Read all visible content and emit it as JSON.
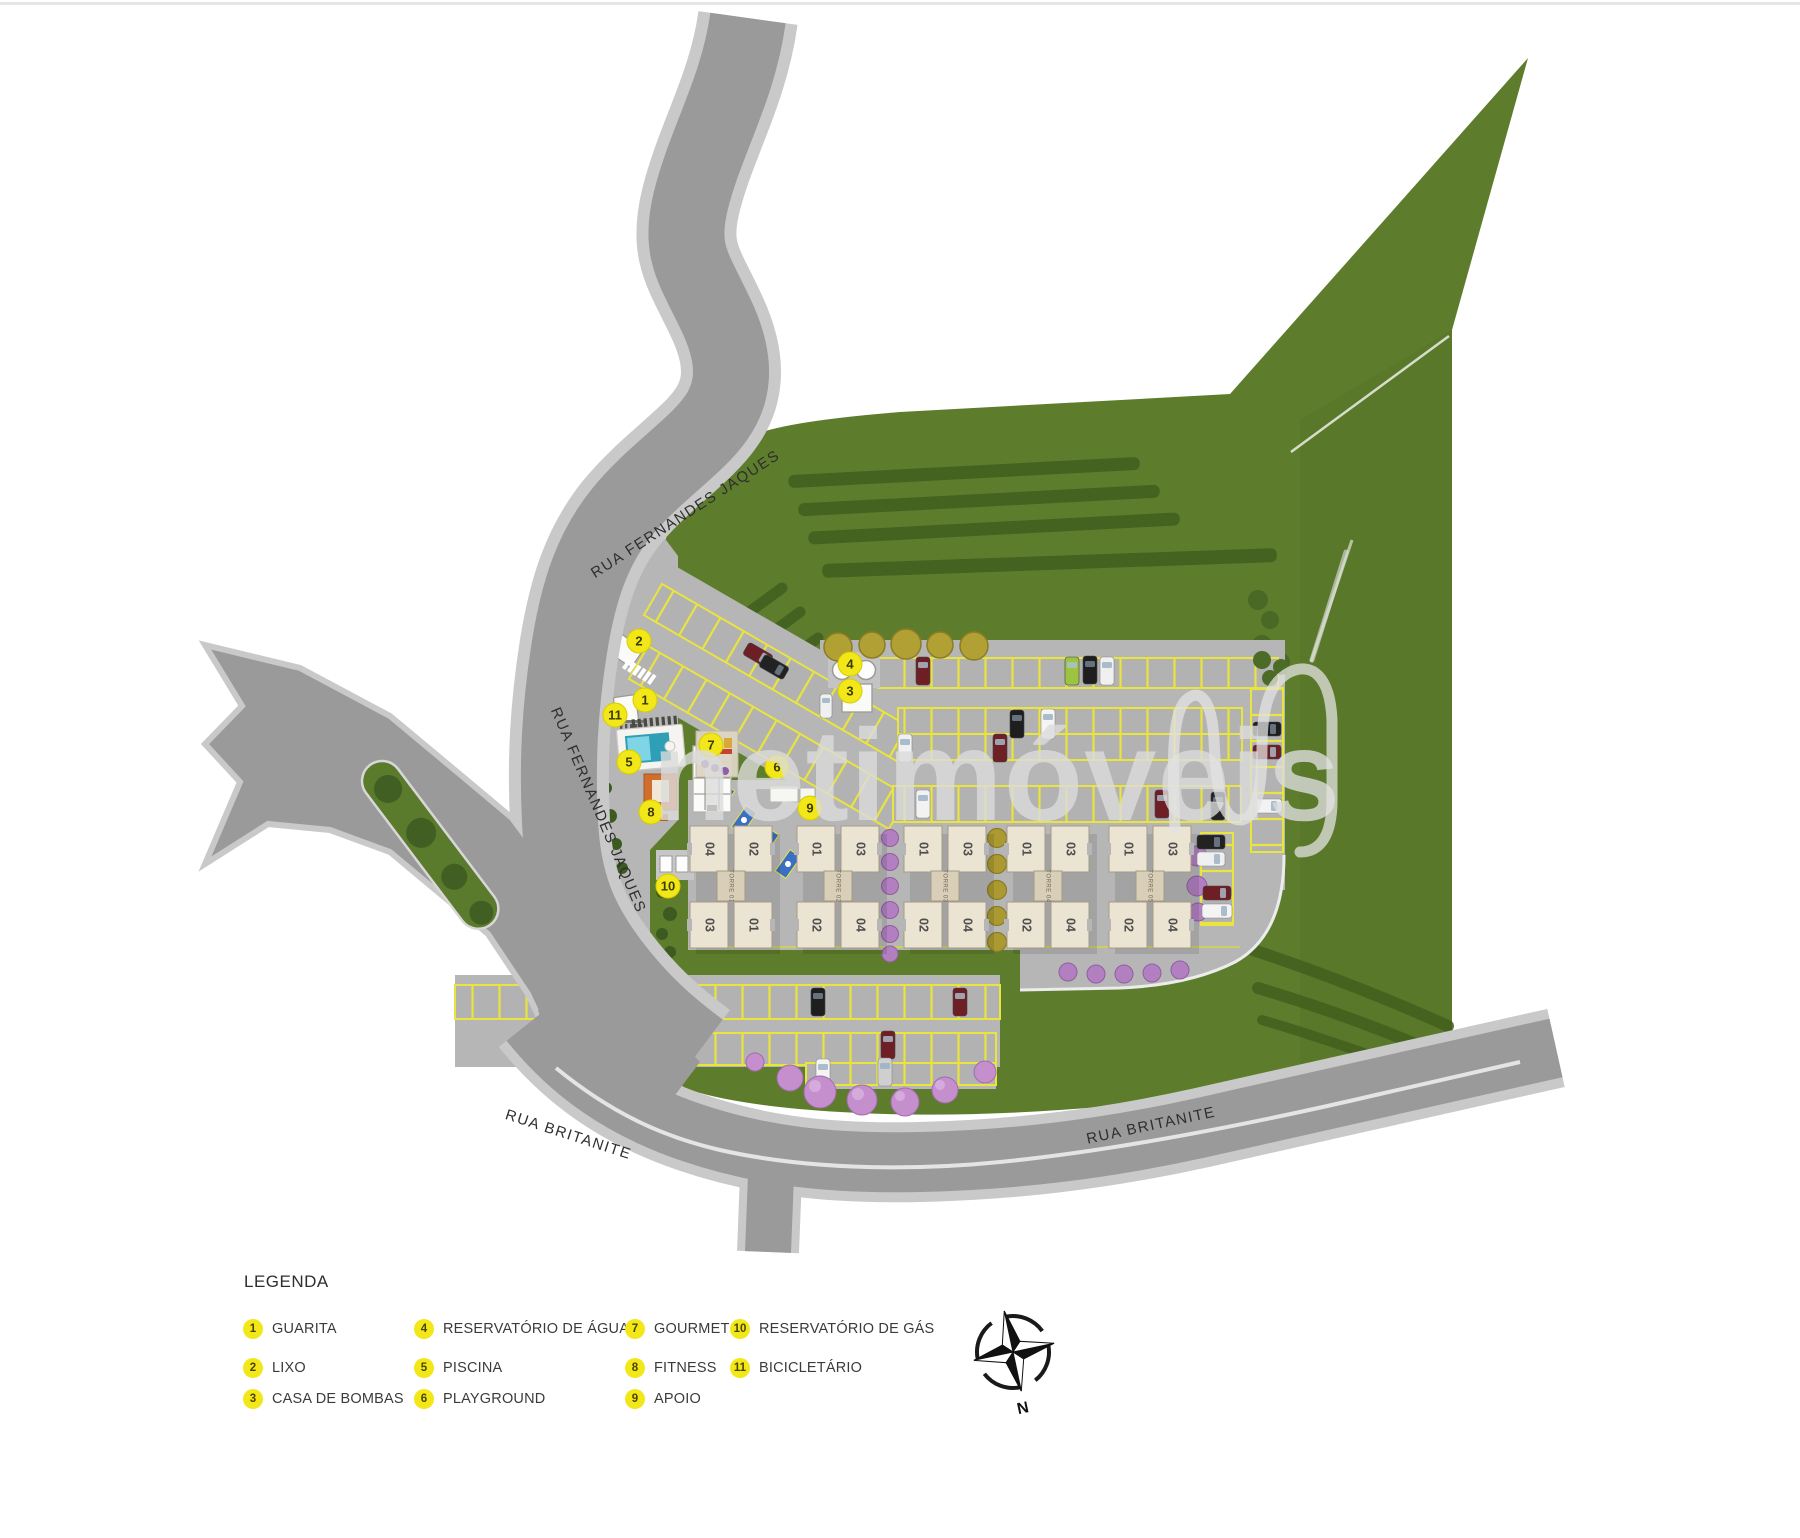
{
  "map": {
    "streets": {
      "fernandes_jaques": "RUA FERNANDES JAQUES",
      "britanite": "RUA BRITANITE"
    },
    "watermark_text": "netimóveis",
    "compass_north": "N",
    "towers": [
      {
        "name": "TORRE 01",
        "units": [
          "04",
          "02",
          "03",
          "01"
        ]
      },
      {
        "name": "TORRE 02",
        "units": [
          "01",
          "03",
          "02",
          "04"
        ]
      },
      {
        "name": "TORRE 03",
        "units": [
          "01",
          "03",
          "02",
          "04"
        ]
      },
      {
        "name": "TORRE 04",
        "units": [
          "01",
          "03",
          "02",
          "04"
        ]
      },
      {
        "name": "TORRE 05",
        "units": [
          "01",
          "03",
          "02",
          "04"
        ]
      }
    ],
    "markers": [
      "1",
      "2",
      "3",
      "4",
      "5",
      "6",
      "7",
      "8",
      "9",
      "10",
      "11"
    ]
  },
  "legend": {
    "title": "LEGENDA",
    "items": [
      {
        "num": "1",
        "label": "GUARITA"
      },
      {
        "num": "2",
        "label": "LIXO"
      },
      {
        "num": "3",
        "label": "CASA DE BOMBAS"
      },
      {
        "num": "4",
        "label": "RESERVATÓRIO DE ÁGUA"
      },
      {
        "num": "5",
        "label": "PISCINA"
      },
      {
        "num": "6",
        "label": "PLAYGROUND"
      },
      {
        "num": "7",
        "label": "GOURMET"
      },
      {
        "num": "8",
        "label": "FITNESS"
      },
      {
        "num": "9",
        "label": "APOIO"
      },
      {
        "num": "10",
        "label": "RESERVATÓRIO DE GÁS"
      },
      {
        "num": "11",
        "label": "BICICLETÁRIO"
      }
    ]
  },
  "colors": {
    "road": "#9a9a9a",
    "sidewalk": "#c9c9c9",
    "pavement": "#b6b6b6",
    "lawn": "#5e7d2c",
    "hedge": "#43611f",
    "stall_yellow": "#e9e43e",
    "tower": "#ece4d2",
    "tower_core": "#d9cfb8",
    "pool": "#53c3d8",
    "marker_yellow": "#f2e719",
    "purple_tree": "#b27fc0",
    "watermark": "#dcdcdc"
  }
}
